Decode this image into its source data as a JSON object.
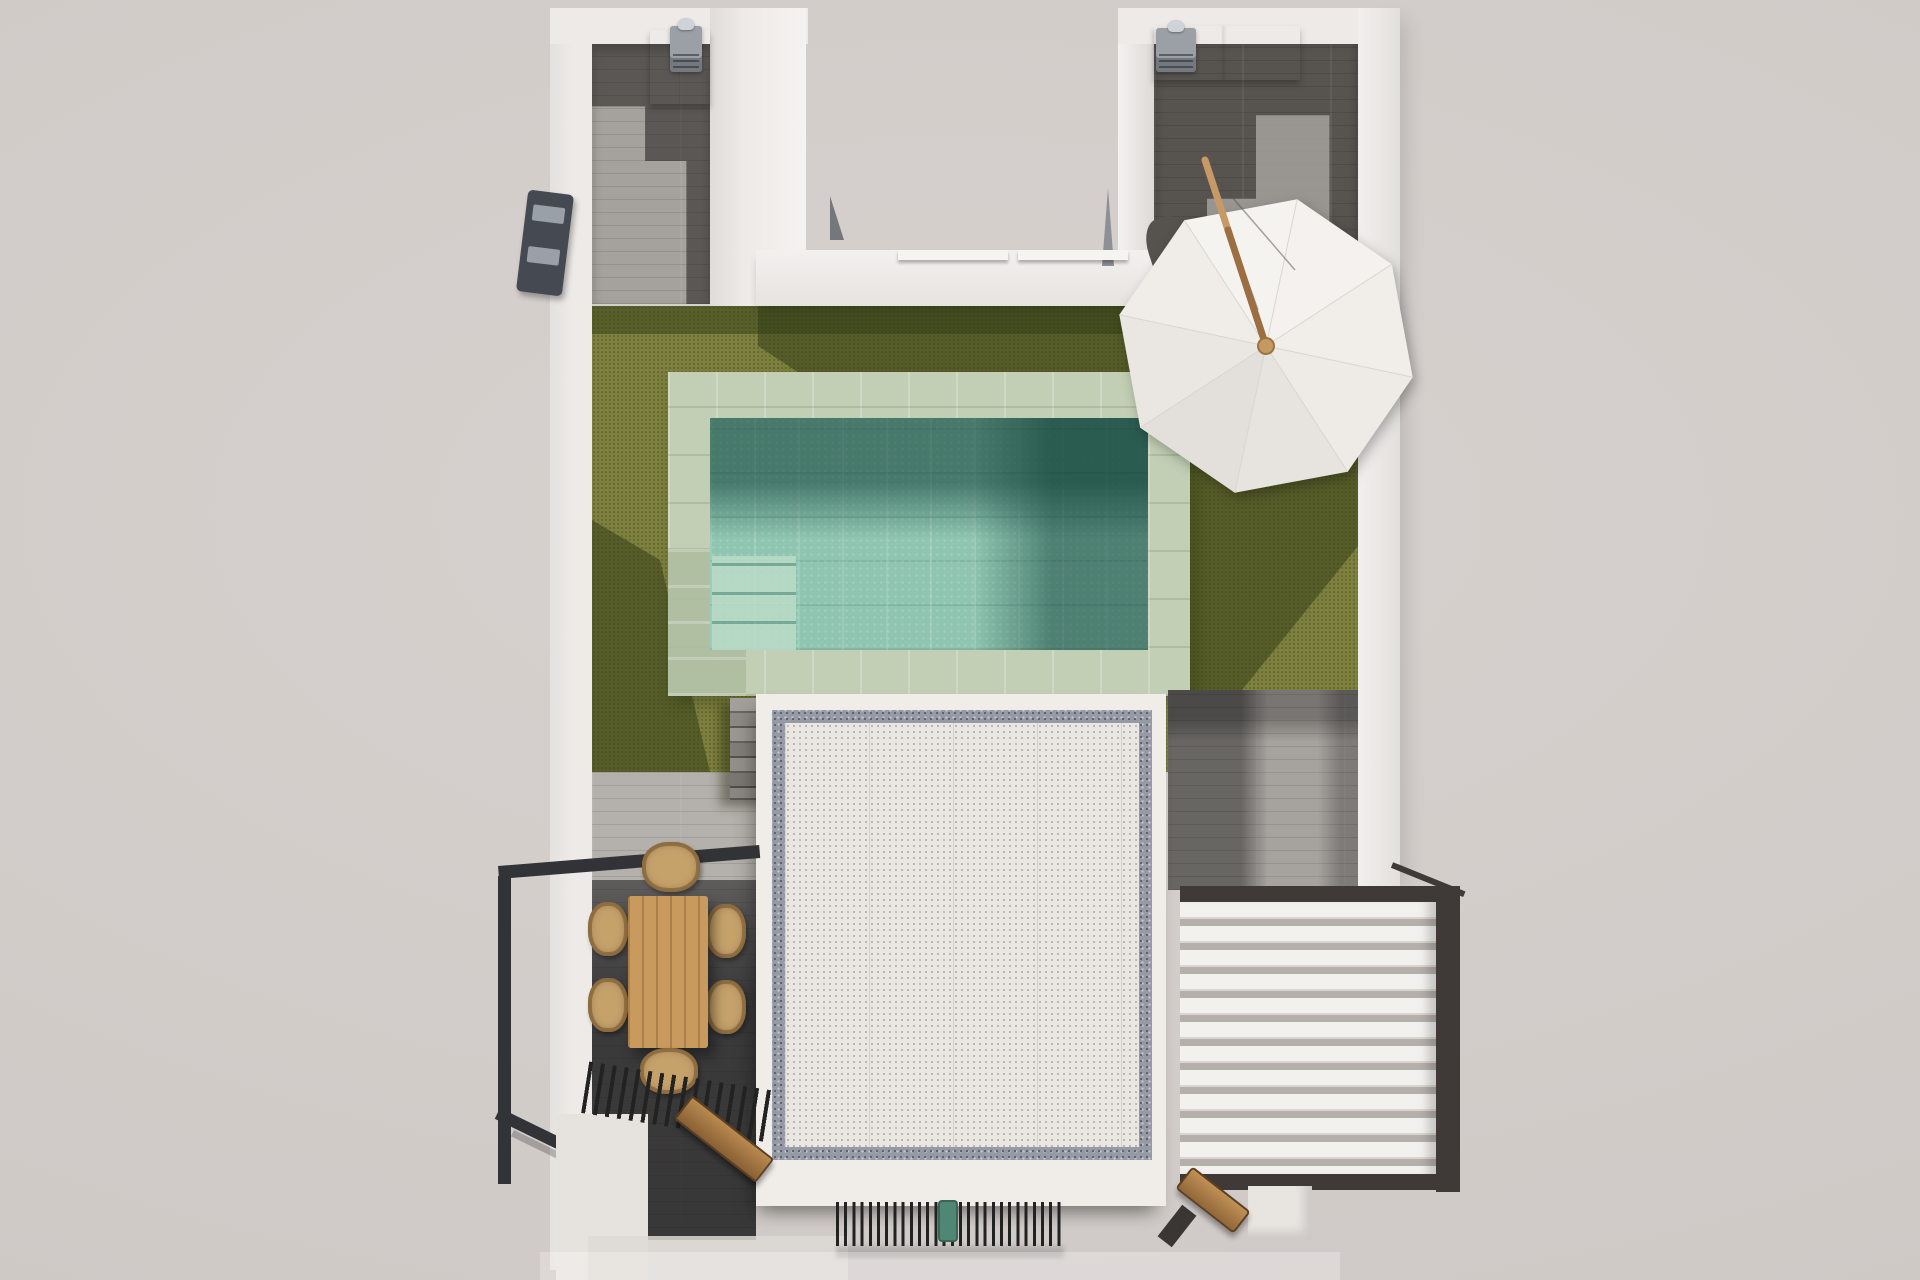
{
  "scene": {
    "label": "Top-down 3D render of a villa roof terrace with pool, lawn, parasol and pergolas",
    "width_px": 1920,
    "height_px": 1280
  },
  "palette": {
    "background": "#d5cfcc",
    "wall": "#edeae7",
    "floor_light": "#a5a19c",
    "floor_dark": "#57534f",
    "plank_light": "#b4b0ab",
    "grass": "#7d7f3e",
    "grass_shadow": "#2f3a14",
    "coping": "#c3cfb5",
    "coping_shade": "#aebda0",
    "water": "#8fc5b1",
    "water_dark": "#3e7166",
    "water_steps": "#bcdcc8",
    "deck_white": "#f0ede9",
    "deck_frame": "#959aa4",
    "deck_inner": "#eae6e2",
    "louver": "#f3f1ee",
    "louver_gap": "#b5b0ac",
    "frame_dark": "#3f3a37",
    "railing": "#323336",
    "slat_dark": "#232223",
    "wood_table": "#c89a5e",
    "wicker": "#c6a26b",
    "bench_wood": "#b9894f",
    "umbrella_white": "#f4f2ef",
    "umbrella_shade": "#e3dfdb",
    "umbrella_pole": "#9c6f42",
    "umbrella_hub": "#c49a62",
    "grill_gray": "#9aa0a6",
    "green_item": "#4f8674"
  },
  "objects": {
    "surroundings": {
      "label": "Pale plaster ground surrounding the plot"
    },
    "walls": {
      "label": "White perimeter parapet walls forming a U at the top"
    },
    "upper_left_room": {
      "label": "Upper-left roof terrace with grey plank decking",
      "cabinet": "White storage cabinet",
      "grill": "Grey outdoor grill unit with chimney dome"
    },
    "upper_right_room": {
      "label": "Upper-right roof terrace with grey plank decking",
      "cabinet": "White storage cabinet",
      "grill": "Grey outdoor grill unit with chimney dome"
    },
    "light_well": {
      "label": "Open light well between the two roof volumes",
      "sill_count": 2
    },
    "wall_unit": {
      "label": "Grey wall-mounted unit on the left parapet"
    },
    "lawn": {
      "label": "Olive artificial-turf lawn with cast shadows"
    },
    "pool": {
      "label": "Rectangular swimming pool",
      "coping": "Pale sage stone coping tiles",
      "water": "Turquoise tiled water, shaded at top and right",
      "steps": "Corner entry steps at lower-left"
    },
    "parasol": {
      "label": "White octagonal parasol with tilted wooden pole",
      "panel_count": 8,
      "pole": "Wooden pole with hub knob"
    },
    "stairs": {
      "label": "Grey steps from lawn down to lower terrace",
      "step_count": 7
    },
    "gravel_deck": {
      "label": "White gravel skylight deck with speckled dark border frame"
    },
    "louver_roof": {
      "label": "White louvered pergola roof in dark frame",
      "slat_count": 12
    },
    "balustrade": {
      "label": "Dark metal balustrade around the lower dining terrace"
    },
    "dining_set": {
      "label": "Timber dining table with wicker chairs",
      "chair_count": 6
    },
    "slatted_canopy": {
      "label": "Dark slatted canopy band over the shaded terrace"
    },
    "bench_terrace": {
      "label": "Timber bench on the shaded lower terrace"
    },
    "bench_corner": {
      "label": "Timber bench at the lower-right corner"
    },
    "grate": {
      "label": "Thin slatted grate strip at the bottom edge",
      "green_object": "Teal object at the grate"
    }
  }
}
